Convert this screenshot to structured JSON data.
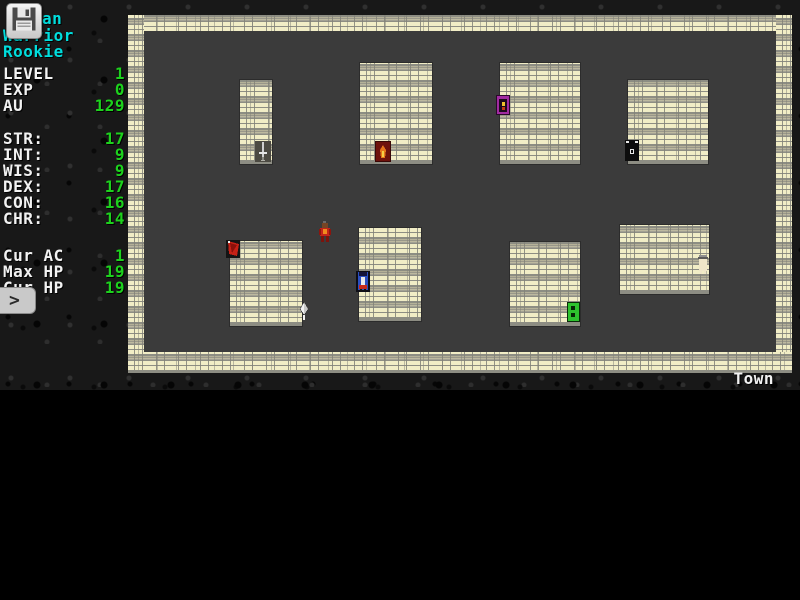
{
  "colors": {
    "text_cyan": "#00dede",
    "text_white": "#f2f2f2",
    "text_green": "#1dd11d",
    "brick": "#f1edc6",
    "mortar": "#8d8d83",
    "floor_grey": "#3b3b3b",
    "background_black": "#000000"
  },
  "sidebar": {
    "name_visible": "an",
    "class_lines": [
      "Warrior",
      "Rookie"
    ],
    "progress": [
      {
        "label": "LEVEL",
        "value": "1"
      },
      {
        "label": "EXP",
        "value": "0"
      },
      {
        "label": "AU",
        "value": "129"
      }
    ],
    "stats": [
      {
        "label": "STR:",
        "value": "17"
      },
      {
        "label": "INT:",
        "value": "9"
      },
      {
        "label": "WIS:",
        "value": "9"
      },
      {
        "label": "DEX:",
        "value": "17"
      },
      {
        "label": "CON:",
        "value": "16"
      },
      {
        "label": "CHR:",
        "value": "14"
      }
    ],
    "combat": [
      {
        "label": "Cur AC",
        "value": "1"
      },
      {
        "label": "Max HP",
        "value": "19"
      },
      {
        "label": "Cur HP",
        "value": "19"
      }
    ],
    "prompt": ">"
  },
  "map": {
    "location_label": "Town",
    "buildings_count": 8,
    "entities": [
      {
        "name": "player-character",
        "desc": "red-armored adventurer standing in street"
      },
      {
        "name": "weapon-sword-entrance",
        "desc": "grey sword on dark doorway, small building bottom-right"
      },
      {
        "name": "flame-door-entrance",
        "desc": "dark red door with orange flame"
      },
      {
        "name": "purple-door-entrance",
        "desc": "magenta doorway with yellow figure"
      },
      {
        "name": "dark-tower-entrance",
        "desc": "black doorway with white crenellation"
      },
      {
        "name": "red-banner-entrance",
        "desc": "red flag at building corner"
      },
      {
        "name": "blue-robed-figure-entrance",
        "desc": "blue robed figure in doorway"
      },
      {
        "name": "green-door-entrance",
        "desc": "bright green panelled door"
      },
      {
        "name": "white-arrow-item",
        "desc": "white arrow/dagger near building corner"
      },
      {
        "name": "pale-figure-entrance",
        "desc": "pale figure with grey cap on building edge"
      }
    ]
  },
  "icons": {
    "save-icon": "floppy-disk",
    "prompt-icon": "chevron-right"
  }
}
